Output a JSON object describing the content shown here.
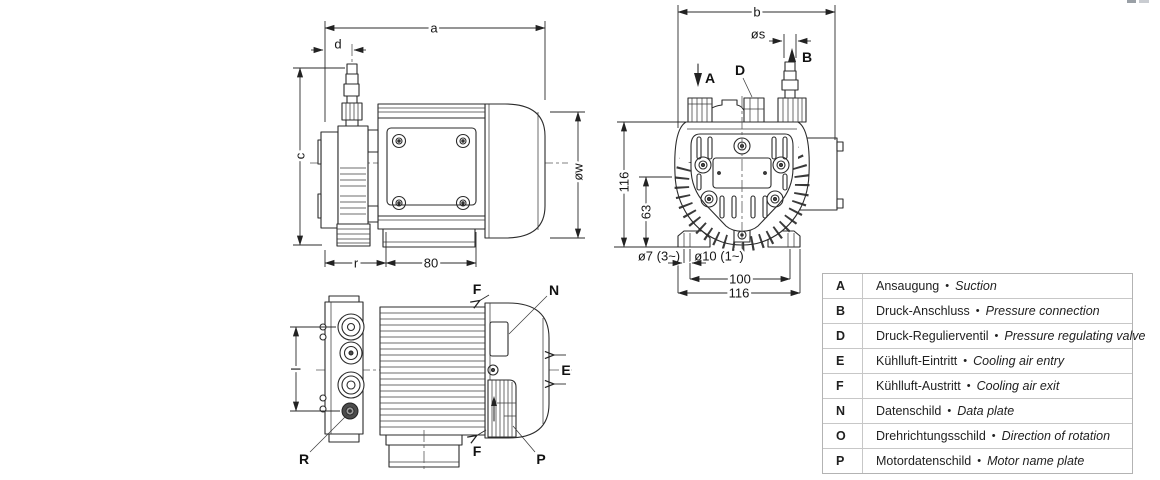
{
  "canvas": {
    "background": "#ffffff",
    "line_color": "#2b2b2b"
  },
  "side_view": {
    "dim_a": "a",
    "dim_d": "d",
    "dim_c": "c",
    "dim_ow": "øw",
    "dim_r": "r",
    "dim_80": "80"
  },
  "front_view": {
    "dim_b": "b",
    "dim_os": "øs",
    "label_suction": "A",
    "label_valve": "D",
    "label_pressure": "B",
    "dim_116_vertical": "116",
    "dim_63": "63",
    "dim_o7": "ø7 (3~)",
    "dim_o10": "ø10 (1~)",
    "dim_100": "100",
    "dim_116_horizontal": "116"
  },
  "top_view": {
    "dim_l": "l",
    "label_f_top": "F",
    "label_n": "N",
    "label_e": "E",
    "label_f_bottom": "F",
    "label_p": "P",
    "label_r": "R"
  },
  "legend": {
    "separator": "•",
    "rows": [
      {
        "key": "A",
        "de": "Ansaugung",
        "en": "Suction"
      },
      {
        "key": "B",
        "de": "Druck-Anschluss",
        "en": "Pressure connection"
      },
      {
        "key": "D",
        "de": "Druck-Regulierventil",
        "en": "Pressure regulating valve"
      },
      {
        "key": "E",
        "de": "Kühlluft-Eintritt",
        "en": "Cooling air entry"
      },
      {
        "key": "F",
        "de": "Kühlluft-Austritt",
        "en": "Cooling air exit"
      },
      {
        "key": "N",
        "de": "Datenschild",
        "en": "Data plate"
      },
      {
        "key": "O",
        "de": "Drehrichtungsschild",
        "en": "Direction of rotation"
      },
      {
        "key": "P",
        "de": "Motordatenschild",
        "en": "Motor name plate"
      }
    ]
  }
}
